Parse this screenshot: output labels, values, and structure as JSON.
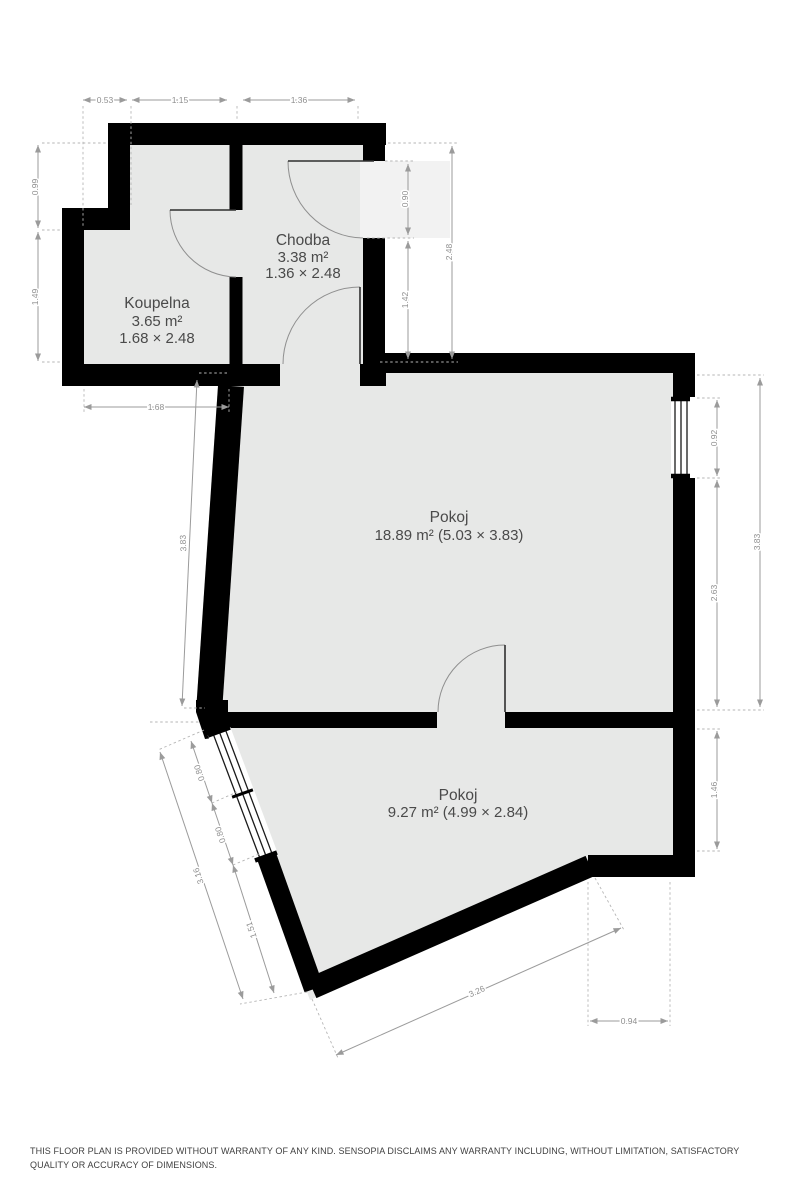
{
  "rooms": {
    "koupelna": {
      "name": "Koupelna",
      "area": "3.65 m²",
      "size": "1.68 × 2.48"
    },
    "chodba": {
      "name": "Chodba",
      "area": "3.38 m²",
      "size": "1.36 × 2.48"
    },
    "pokoj_large": {
      "name": "Pokoj",
      "details": "18.89 m² (5.03 × 3.83)"
    },
    "pokoj_small": {
      "name": "Pokoj",
      "details": "9.27 m² (4.99 × 2.84)"
    }
  },
  "dims": {
    "top": [
      "0.53",
      "1.15",
      "1.36"
    ],
    "left_upper": [
      "0.99",
      "1.49"
    ],
    "koupelna_width": "1.68",
    "pokoj_left_height": "3.83",
    "chodba_right": [
      "0.90",
      "1.42",
      "2.48"
    ],
    "right": [
      "0.92",
      "2.63",
      "3.83",
      "1.46"
    ],
    "bottom_right_width": "0.94",
    "bottom_slant": "3.26",
    "left_slant": [
      "0.80",
      "0.80",
      "1.51",
      "3.16"
    ]
  },
  "disclaimer": "THIS FLOOR PLAN IS PROVIDED WITHOUT WARRANTY OF ANY KIND. SENSOPIA DISCLAIMS ANY WARRANTY INCLUDING, WITHOUT LIMITATION, SATISFACTORY QUALITY OR ACCURACY OF DIMENSIONS."
}
